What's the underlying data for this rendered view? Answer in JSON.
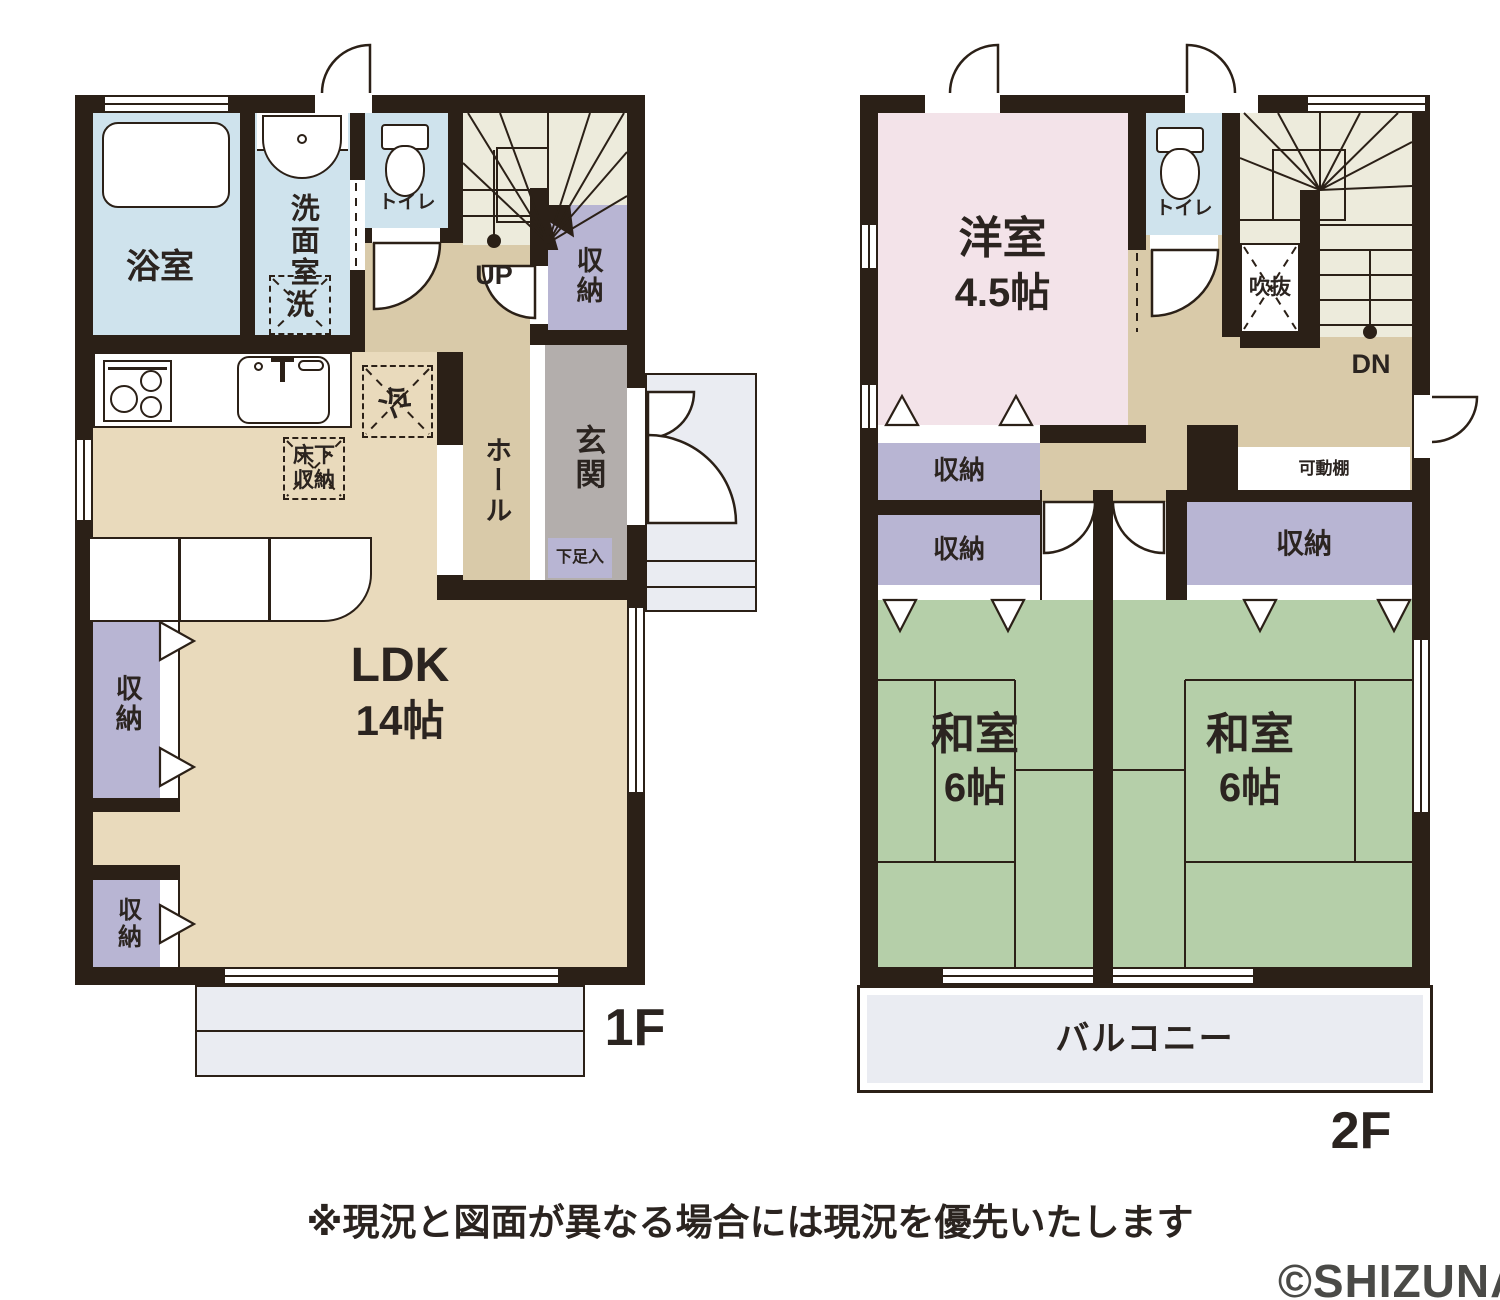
{
  "colors": {
    "wall": "#2b2017",
    "water": "#cfe3ed",
    "cream": "#edebdc",
    "tan_light": "#e9dabc",
    "tan_dark": "#d9caa9",
    "purple": "#b8b5d3",
    "gray": "#b3aeac",
    "pink": "#f3e3e9",
    "green": "#b5cfa9",
    "porch": "#eaecf2",
    "text": "#2b2420",
    "copyright": "#4a4a47"
  },
  "f1": {
    "floor_label": "1F",
    "bath": "浴室",
    "washroom": "洗面室",
    "washing_machine": "洗",
    "toilet": "トイレ",
    "stairs_up": "UP",
    "stair_storage": "収納",
    "hall": "ホール",
    "entrance": "玄関",
    "shoe_box": "下足入",
    "fridge": "冷",
    "underfloor_1": "床下",
    "underfloor_2": "収納",
    "ldk": "LDK",
    "ldk_size": "14帖",
    "storage_mid": "収納",
    "storage_bottom": "収納"
  },
  "f2": {
    "floor_label": "2F",
    "western_room": "洋室",
    "western_size": "4.5帖",
    "toilet": "トイレ",
    "void": "吹抜",
    "stairs_down": "DN",
    "movable_shelf": "可動棚",
    "storage_a": "収納",
    "storage_b": "収納",
    "storage_c": "収納",
    "tatami_left": "和室",
    "tatami_left_size": "6帖",
    "tatami_right": "和室",
    "tatami_right_size": "6帖",
    "balcony": "バルコニー"
  },
  "footer": {
    "disclaimer": "※現況と図面が異なる場合には現況を優先いたします",
    "copyright": "©SHIZUNAVI"
  }
}
